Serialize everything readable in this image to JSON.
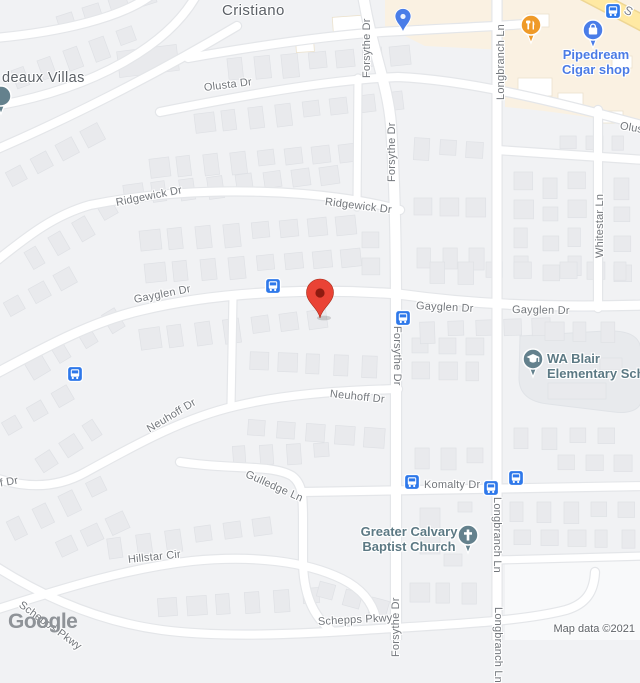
{
  "map": {
    "attribution": "Map data ©2021",
    "logo_text": "Google",
    "colors": {
      "background": "#f1f2f4",
      "road": "#ffffff",
      "road_casing": "#e4e6e9",
      "building": "#e9eaed",
      "building_stroke": "#dfe1e5",
      "commercial_bg": "#faf1e2",
      "school_grounds": "#e8eaed",
      "highway_yellow": "#ffe9a3",
      "highway_casing": "#eed694",
      "marker_red": "#EA4335",
      "marker_dark": "#8e1b10",
      "transit_blue": "#2e78ea",
      "poi_orange": "#EF9A28",
      "poi_blue": "#4a7de8",
      "poi_slate": "#64818d",
      "empty_lot": "#f8f9fa"
    },
    "area_labels": [
      {
        "text": "Cristiano"
      },
      {
        "text": "deaux Villas"
      }
    ],
    "street_labels": [
      {
        "text": "Olusta Dr"
      },
      {
        "text": "Olusta Dr"
      },
      {
        "text": "Ridgewick Dr"
      },
      {
        "text": "Ridgewick Dr"
      },
      {
        "text": "Forsythe Dr"
      },
      {
        "text": "Forsythe Dr"
      },
      {
        "text": "Forsythe Dr"
      },
      {
        "text": "Forsythe Dr"
      },
      {
        "text": "Gayglen Dr"
      },
      {
        "text": "Gayglen Dr"
      },
      {
        "text": "Gayglen Dr"
      },
      {
        "text": "Longbranch Ln"
      },
      {
        "text": "Longbranch Ln"
      },
      {
        "text": "Longbranch Ln"
      },
      {
        "text": "Whitestar Ln"
      },
      {
        "text": "Neuhoff Dr"
      },
      {
        "text": "Neuhoff Dr"
      },
      {
        "text": "Neuhoff Dr"
      },
      {
        "text": "Gulledge Ln"
      },
      {
        "text": "Komalty Dr"
      },
      {
        "text": "Hillstar Cir"
      },
      {
        "text": "Schepps Pkwy"
      },
      {
        "text": "Schepps Pkwy"
      },
      {
        "text": "S"
      }
    ],
    "pois": [
      {
        "label_line1": "Pipedream",
        "label_line2": "Cigar shop",
        "icon": "shopping-bag"
      },
      {
        "label_line1": "WA Blair",
        "label_line2": "Elementary Sch",
        "icon": "graduation-cap"
      },
      {
        "label_line1": "Greater Calvary",
        "label_line2": "Baptist Church",
        "icon": "cross"
      },
      {
        "label_line1": "",
        "label_line2": "",
        "icon": "restaurant"
      }
    ],
    "transit_stop_count": 7
  }
}
